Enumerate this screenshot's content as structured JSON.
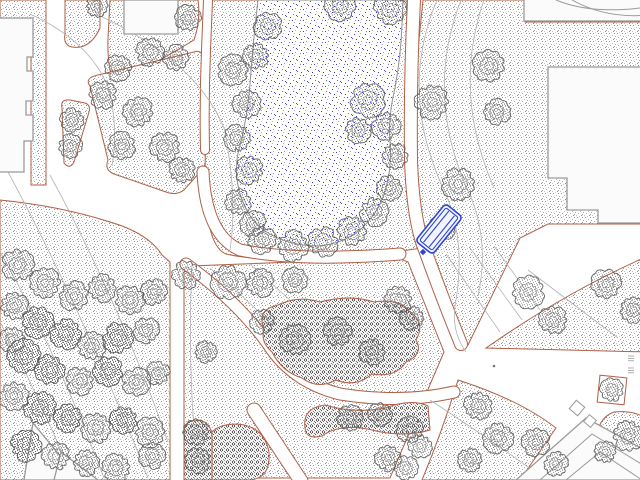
{
  "canvas": {
    "width": 640,
    "height": 480,
    "background": "#ffffff"
  },
  "palette": {
    "bed_outline": "#b06046",
    "grass_dot": "#9a9a9a",
    "shrub_dot": "#5a5a5a",
    "tree_stroke": "#585858",
    "contour": "#b3b3b3",
    "water_dot": "#3434c8",
    "pond_outline": "#909090",
    "building_outline": "#9a9a9a",
    "building_fill": "#fbfbfb",
    "selection_blue": "#2f46cf"
  },
  "selection": {
    "object": "bench",
    "color": "#2f46cf"
  },
  "features": {
    "grass_areas": [
      {
        "id": "lawn-topleft-L",
        "d": "M0,0 L46,0 L46,185 L31,185 L31,25 L0,25 Z"
      },
      {
        "id": "lawn-strip",
        "d": "M65,0 L100,0 L100,28 Q90,50 72,47 Q63,45 65,34 Z"
      },
      {
        "id": "lawn-north-block",
        "d": "M110,0 L198,0 Q201,20 194,40 L116,86 Q107,72 108,38 Z"
      },
      {
        "id": "lawn-island-small",
        "d": "M62,108 Q60,99 70,100 L85,103 Q91,105 89,112 L74,162 Q70,170 64,163 Z"
      },
      {
        "id": "lawn-triangle",
        "d": "M90,86 Q84,78 98,75 L194,52 Q202,49 203,59 L206,150 Q208,164 200,172 L184,190 Q176,196 166,192 L114,174 Q104,170 108,160 Z"
      },
      {
        "id": "pond-shore",
        "d": "M212,0 L408,0 Q404,80 406,160 Q408,212 422,248 L340,260 Q260,262 226,254 Q206,246 205,180 Q206,60 212,0 Z"
      },
      {
        "id": "lawn-east-field",
        "d": "M423,0 L525,0 L525,22 L648,22 L648,224 L548,224 L520,238 L468,345 L456,345 L421,252 Q414,160 417,60 Z"
      },
      {
        "id": "lawn-west-field",
        "d": "M0,200 Q60,206 110,222 Q148,233 162,255 L170,262 L170,480 L0,480 Z"
      },
      {
        "id": "lawn-center-south",
        "d": "M190,266 L398,258 L408,262 L444,352 L390,478 L184,478 L184,272 Z"
      },
      {
        "id": "lawn-east-wedge",
        "d": "M648,256 Q566,292 486,348 L648,352 Z"
      },
      {
        "id": "lawn-southeast",
        "d": "M458,380 Q520,400 556,428 L520,480 L422,480 Q442,432 458,380 Z"
      },
      {
        "id": "lawn-se-corner",
        "d": "M598,456 Q592,420 614,412 Q636,410 648,420 L648,456 Z"
      }
    ],
    "footpaths": [
      {
        "id": "path-upper-shore",
        "d": "M208,0 L206,50 Q204,100 205,150",
        "w": 8
      },
      {
        "id": "path-pond-south",
        "d": "M203,172 Q206,235 240,250 Q300,262 400,254",
        "w": 11
      },
      {
        "id": "path-east-main",
        "d": "M414,0 Q410,80 411,160 Q413,220 425,250 Q443,300 461,344",
        "w": 12
      },
      {
        "id": "path-diagonal-center",
        "d": "M186,264 Q238,302 268,344 Q292,382 340,394 Q402,404 454,392",
        "w": 11
      },
      {
        "id": "path-south-cut",
        "d": "M254,410 L301,481",
        "w": 13
      }
    ],
    "contours": [
      "M30,14 Q92,42 110,92 Q118,132 112,166",
      "M96,14 Q196,60 224,128 Q238,196 230,250",
      "M8,172 Q80,305 148,478",
      "M0,252 Q52,342 104,478",
      "M50,175 Q118,300 168,442",
      "M0,322 Q42,402 72,478",
      "M437,0 Q398,92 444,190 Q466,238 456,300 Q450,330 466,352",
      "M461,0 Q424,95 469,193 Q490,240 478,296",
      "M484,0 Q452,92 494,188",
      "M446,254 L500,332",
      "M470,248 L522,320",
      "M494,246 L540,310",
      "M528,270 L618,338",
      "M210,268 Q262,312 298,352",
      "M250,264 Q310,318 352,356",
      "M192,264 Q188,350 194,430 Q197,458 204,478",
      "M430,400 Q500,446 540,476",
      "M196,420 Q240,448 268,478"
    ],
    "pond": {
      "d": "M258,0 Q253,42 250,84 Q248,112 241,142 Q233,166 239,190 Q245,216 265,231 Q288,246 318,246 Q344,244 362,228 Q380,211 386,188 Q392,166 390,142 Q388,116 395,88 Q401,55 402,24 L403,0 Z"
    },
    "shrub_masses": [
      {
        "id": "shrub-central",
        "d": "M264,328 Q256,310 278,305 Q298,295 320,302 Q350,294 374,302 Q400,298 410,312 Q426,322 416,340 Q424,354 406,362 Q396,378 372,374 Q356,388 336,380 Q318,390 302,378 Q282,372 272,352 Q260,342 264,328 Z"
      },
      {
        "id": "shrub-south-band",
        "d": "M305,428 Q302,408 325,405 Q355,414 385,408 Q412,398 428,406 L430,430 Q404,438 372,430 Q340,423 322,436 Q306,440 305,428 Z"
      },
      {
        "id": "shrub-mound",
        "d": "M206,444 Q210,424 237,424 Q264,426 269,452 Q271,478 250,480 L212,480 Q204,462 206,444 Z"
      },
      {
        "id": "shrub-mound-west",
        "d": "M184,432 Q184,420 198,420 Q212,422 212,438 L212,480 L184,480 Z"
      }
    ],
    "buildings": [
      {
        "id": "building-west",
        "d": "M-8,18 L33,18 L33,57 L27,57 L27,71 L33,71 L33,101 L26,101 L26,115 L33,115 L33,141 L24,141 L24,172 L-8,172 Z"
      },
      {
        "id": "building-north",
        "d": "M124,0 L178,0 L178,34 L124,34 Z"
      },
      {
        "id": "building-northeast-strip",
        "d": "M524,-4 L648,-4 L648,21 L524,21 Z"
      },
      {
        "id": "building-east",
        "d": "M548,67 L648,67 L648,223 L598,223 L598,210 L567,210 L567,178 L548,178 Z"
      },
      {
        "id": "building-southwest-a",
        "d": "M33,423 L24,480 L80,480 Z"
      },
      {
        "id": "building-southwest-b",
        "d": "M61,452 L54,480 L98,480 Z"
      },
      {
        "id": "building-southeast",
        "d": "M516,480 L586,418 L648,452 L648,480 Z"
      }
    ],
    "building_lines": [
      "M556,0 Q592,15 648,7",
      "M572,0 Q606,19 648,15",
      "M540,480 L592,434 L648,468",
      "M566,480 L600,452 L642,480"
    ],
    "building_squares": [
      {
        "x": 577,
        "y": 408,
        "s": 11,
        "rot": 40
      },
      {
        "x": 590,
        "y": 421,
        "s": 9,
        "rot": 40
      }
    ],
    "trees": [
      {
        "x": 233,
        "y": 70,
        "r": 14
      },
      {
        "x": 247,
        "y": 104,
        "r": 13
      },
      {
        "x": 237,
        "y": 138,
        "r": 12
      },
      {
        "x": 249,
        "y": 170,
        "r": 13
      },
      {
        "x": 238,
        "y": 202,
        "r": 12
      },
      {
        "x": 253,
        "y": 224,
        "r": 12
      },
      {
        "x": 268,
        "y": 26,
        "r": 13
      },
      {
        "x": 256,
        "y": 56,
        "r": 12
      },
      {
        "x": 340,
        "y": 6,
        "r": 14
      },
      {
        "x": 390,
        "y": 8,
        "r": 15
      },
      {
        "x": 368,
        "y": 100,
        "r": 16
      },
      {
        "x": 386,
        "y": 126,
        "r": 13
      },
      {
        "x": 358,
        "y": 130,
        "r": 12
      },
      {
        "x": 262,
        "y": 240,
        "r": 13
      },
      {
        "x": 293,
        "y": 246,
        "r": 14
      },
      {
        "x": 323,
        "y": 242,
        "r": 14
      },
      {
        "x": 352,
        "y": 231,
        "r": 14
      },
      {
        "x": 374,
        "y": 212,
        "r": 13
      },
      {
        "x": 389,
        "y": 188,
        "r": 12
      },
      {
        "x": 395,
        "y": 156,
        "r": 12
      },
      {
        "x": 432,
        "y": 102,
        "r": 16
      },
      {
        "x": 489,
        "y": 66,
        "r": 15
      },
      {
        "x": 497,
        "y": 112,
        "r": 12
      },
      {
        "x": 458,
        "y": 184,
        "r": 15
      },
      {
        "x": 442,
        "y": 228,
        "r": 12
      },
      {
        "x": 528,
        "y": 292,
        "r": 15
      },
      {
        "x": 553,
        "y": 320,
        "r": 13
      },
      {
        "x": 606,
        "y": 284,
        "r": 14
      },
      {
        "x": 633,
        "y": 310,
        "r": 12
      },
      {
        "x": 186,
        "y": 275,
        "r": 13
      },
      {
        "x": 228,
        "y": 282,
        "r": 16
      },
      {
        "x": 260,
        "y": 283,
        "r": 13
      },
      {
        "x": 295,
        "y": 280,
        "r": 12
      },
      {
        "x": 398,
        "y": 300,
        "r": 13
      },
      {
        "x": 412,
        "y": 318,
        "r": 11
      },
      {
        "x": 206,
        "y": 352,
        "r": 10
      },
      {
        "x": 295,
        "y": 340,
        "r": 14
      },
      {
        "x": 338,
        "y": 332,
        "r": 13
      },
      {
        "x": 372,
        "y": 352,
        "r": 12
      },
      {
        "x": 262,
        "y": 322,
        "r": 11
      },
      {
        "x": 350,
        "y": 418,
        "r": 12
      },
      {
        "x": 380,
        "y": 414,
        "r": 11
      },
      {
        "x": 410,
        "y": 430,
        "r": 12
      },
      {
        "x": 420,
        "y": 446,
        "r": 11
      },
      {
        "x": 388,
        "y": 458,
        "r": 12
      },
      {
        "x": 406,
        "y": 468,
        "r": 11
      },
      {
        "x": 196,
        "y": 432,
        "r": 12
      },
      {
        "x": 198,
        "y": 460,
        "r": 12
      },
      {
        "x": 478,
        "y": 406,
        "r": 13
      },
      {
        "x": 498,
        "y": 438,
        "r": 14
      },
      {
        "x": 470,
        "y": 460,
        "r": 11
      },
      {
        "x": 536,
        "y": 442,
        "r": 13
      },
      {
        "x": 556,
        "y": 464,
        "r": 11
      },
      {
        "x": 628,
        "y": 436,
        "r": 14
      },
      {
        "x": 605,
        "y": 452,
        "r": 10
      },
      {
        "x": 612,
        "y": 390,
        "r": 11
      },
      {
        "x": 103,
        "y": 95,
        "r": 13
      },
      {
        "x": 138,
        "y": 112,
        "r": 14
      },
      {
        "x": 122,
        "y": 146,
        "r": 13
      },
      {
        "x": 165,
        "y": 147,
        "r": 14
      },
      {
        "x": 182,
        "y": 170,
        "r": 12
      },
      {
        "x": 72,
        "y": 120,
        "r": 11
      },
      {
        "x": 70,
        "y": 146,
        "r": 11
      },
      {
        "x": 150,
        "y": 52,
        "r": 13
      },
      {
        "x": 176,
        "y": 58,
        "r": 12
      },
      {
        "x": 118,
        "y": 68,
        "r": 12
      },
      {
        "x": 188,
        "y": 18,
        "r": 12
      },
      {
        "x": 97,
        "y": 6,
        "r": 10
      },
      {
        "x": 18,
        "y": 265,
        "r": 15
      },
      {
        "x": 45,
        "y": 283,
        "r": 14
      },
      {
        "x": 74,
        "y": 296,
        "r": 14
      },
      {
        "x": 102,
        "y": 288,
        "r": 13
      },
      {
        "x": 130,
        "y": 300,
        "r": 14
      },
      {
        "x": 154,
        "y": 292,
        "r": 12
      },
      {
        "x": 14,
        "y": 306,
        "r": 13
      },
      {
        "x": 38,
        "y": 322,
        "r": 15,
        "dark": true
      },
      {
        "x": 66,
        "y": 334,
        "r": 14,
        "dark": true
      },
      {
        "x": 92,
        "y": 346,
        "r": 13
      },
      {
        "x": 118,
        "y": 338,
        "r": 14,
        "dark": true
      },
      {
        "x": 146,
        "y": 330,
        "r": 12
      },
      {
        "x": 24,
        "y": 356,
        "r": 15,
        "dark": true
      },
      {
        "x": 50,
        "y": 370,
        "r": 14,
        "dark": true
      },
      {
        "x": 80,
        "y": 381,
        "r": 13
      },
      {
        "x": 108,
        "y": 371,
        "r": 14,
        "dark": true
      },
      {
        "x": 136,
        "y": 382,
        "r": 13
      },
      {
        "x": 158,
        "y": 373,
        "r": 11
      },
      {
        "x": 14,
        "y": 396,
        "r": 14
      },
      {
        "x": 40,
        "y": 408,
        "r": 15,
        "dark": true
      },
      {
        "x": 68,
        "y": 418,
        "r": 13,
        "dark": true
      },
      {
        "x": 96,
        "y": 428,
        "r": 14
      },
      {
        "x": 124,
        "y": 420,
        "r": 13,
        "dark": true
      },
      {
        "x": 150,
        "y": 432,
        "r": 14
      },
      {
        "x": 26,
        "y": 446,
        "r": 14,
        "dark": true
      },
      {
        "x": 56,
        "y": 456,
        "r": 13
      },
      {
        "x": 86,
        "y": 463,
        "r": 12
      },
      {
        "x": 116,
        "y": 468,
        "r": 13
      },
      {
        "x": 12,
        "y": 340,
        "r": 12
      },
      {
        "x": 152,
        "y": 456,
        "r": 12
      }
    ],
    "markers": {
      "tree_box": {
        "x": 612,
        "y": 390,
        "size": 27,
        "rot": 6
      },
      "junction_dot": {
        "x": 494,
        "y": 366,
        "r": 1.3
      },
      "edge_marks": [
        {
          "x": 628,
          "y": 356
        },
        {
          "x": 628,
          "y": 368
        }
      ]
    },
    "bench": {
      "cx": 439,
      "cy": 229,
      "angle": -51,
      "length": 48,
      "width": 22,
      "slats": 2,
      "anchor": {
        "x": 423,
        "y": 252,
        "s": 4.5
      }
    }
  }
}
